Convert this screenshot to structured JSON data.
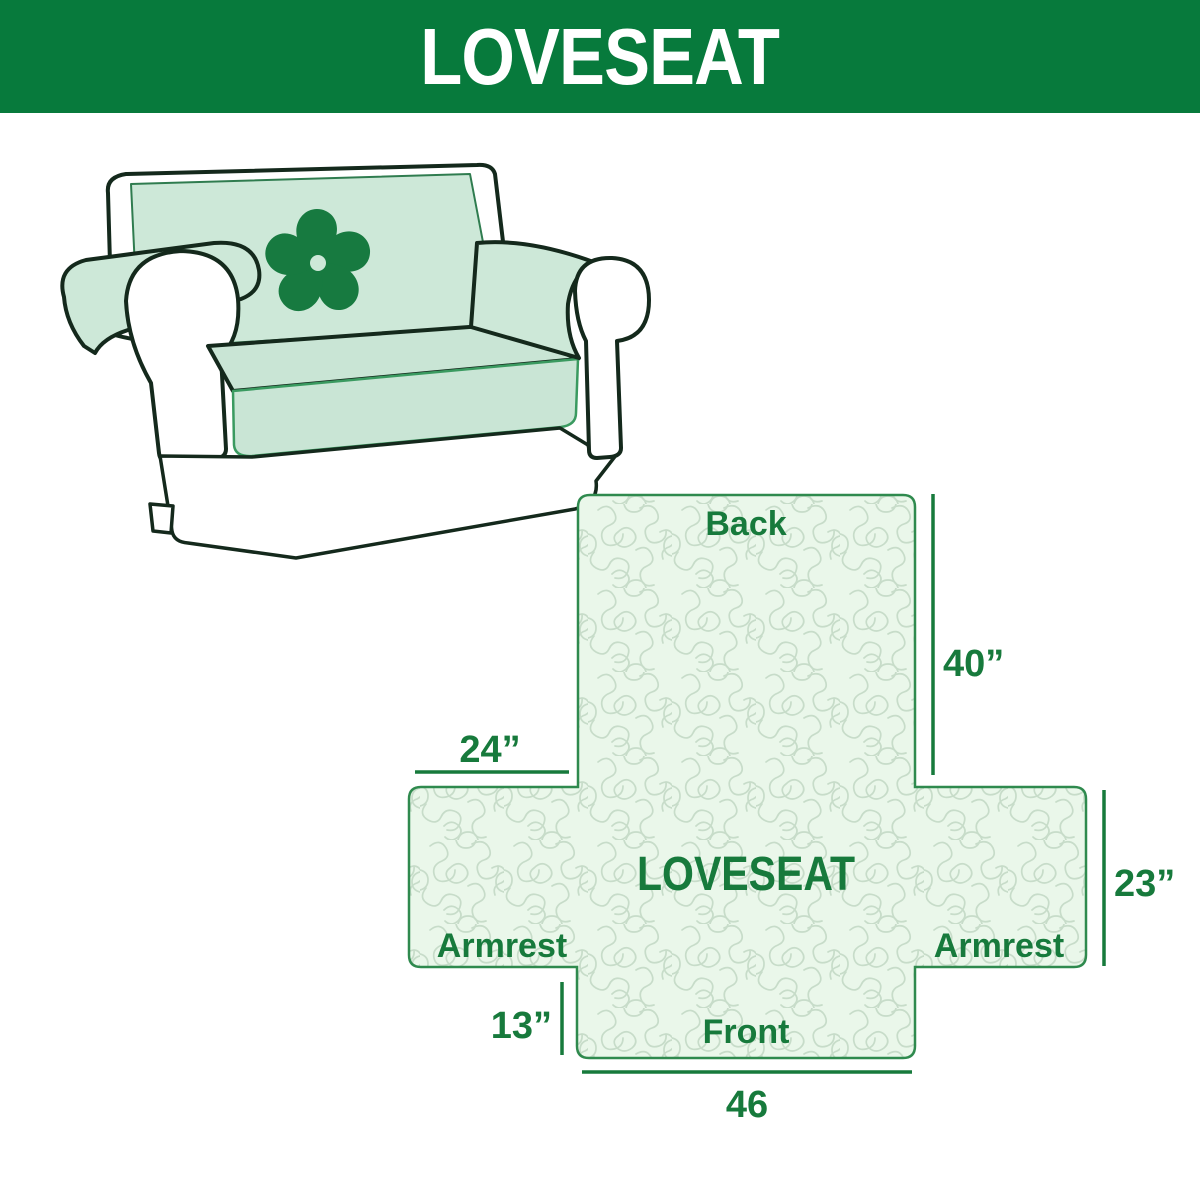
{
  "banner": {
    "title": "LOVESEAT",
    "bg_color": "#077a3c",
    "text_color": "#ffffff"
  },
  "illustration": {
    "alt": "line drawing of a two-seat loveseat sofa with a quilted slipcover",
    "logo_icon": "pinwheel-icon",
    "colors": {
      "cover_mint": "#cde8d8",
      "seat_mint": "#c9e5d5",
      "outline": "#14291c",
      "skirt_edge": "#3a9a60",
      "logo_green": "#177a40"
    }
  },
  "diagram": {
    "center_label": "LOVESEAT",
    "labels": {
      "back": "Back",
      "front": "Front",
      "armrest_left": "Armrest",
      "armrest_right": "Armrest"
    },
    "dimensions": {
      "back_height": "40”",
      "armrest_width": "24”",
      "armrest_height": "23”",
      "front_skirt_height": "13”",
      "front_width": "46"
    },
    "colors": {
      "fill": "#eaf7ea",
      "pattern_line": "#c7dcc9",
      "border": "#2f8a4e",
      "text": "#177a3c"
    }
  }
}
